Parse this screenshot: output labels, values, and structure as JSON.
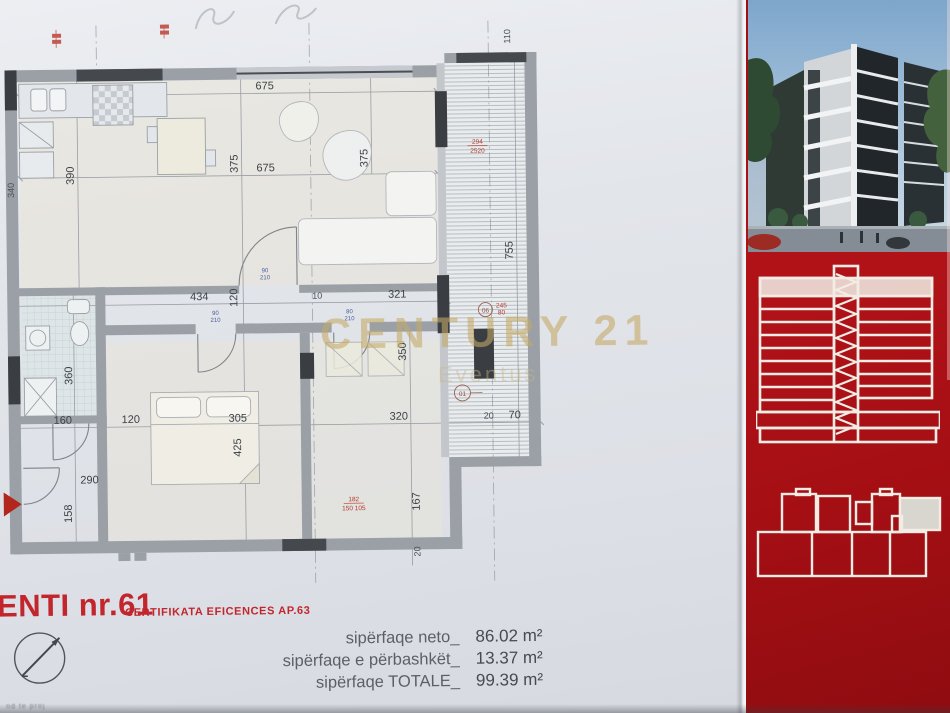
{
  "photo": {
    "watermark": {
      "brand": "CENTURY 21",
      "office": "Eventus"
    },
    "title_block": {
      "title": "ENTI nr.61",
      "certificate": "CERTIFIKATA EFICENCES AP.63",
      "areas": [
        {
          "label": "sipërfaqe neto_",
          "value": "86.02 m²"
        },
        {
          "label": "sipërfaqe e përbashkët_",
          "value": "13.37 m²"
        },
        {
          "label": "sipërfaqe TOTALE_",
          "value": "99.39 m²"
        }
      ],
      "footnote": "nd te proj"
    },
    "plan": {
      "dims": {
        "top_width_1": "675",
        "living_depth_1": "375",
        "top_width_2": "675",
        "living_depth_2": "375",
        "kitchen_depth": "390",
        "left_edge": "340",
        "terrace_top": "110",
        "hall_w1": "434",
        "hall_w2": "120",
        "hall_w3": "10",
        "hall_w4": "321",
        "bath_depth": "360",
        "bed2_depth": "350",
        "terrace_len": "755",
        "low_w1": "160",
        "low_w2": "120",
        "low_w3": "305",
        "low_w4": "320",
        "low_w5": "20",
        "low_w6": "70",
        "bed1_depth": "425",
        "entry_w": "290",
        "entry_d": "158",
        "bed2_low": "167",
        "wall_20": "20"
      },
      "door_sizes": {
        "w1": "90",
        "h1": "210",
        "w2": "90",
        "h2": "210",
        "w3": "80",
        "h3": "210"
      },
      "red_dims": {
        "terrace_a": "294",
        "terrace_b": "2520",
        "entry_a": "182",
        "entry_b": "150 105",
        "col_a": "245",
        "col_b": "80"
      },
      "markers": {
        "m1": "01",
        "m2": "06"
      }
    }
  }
}
